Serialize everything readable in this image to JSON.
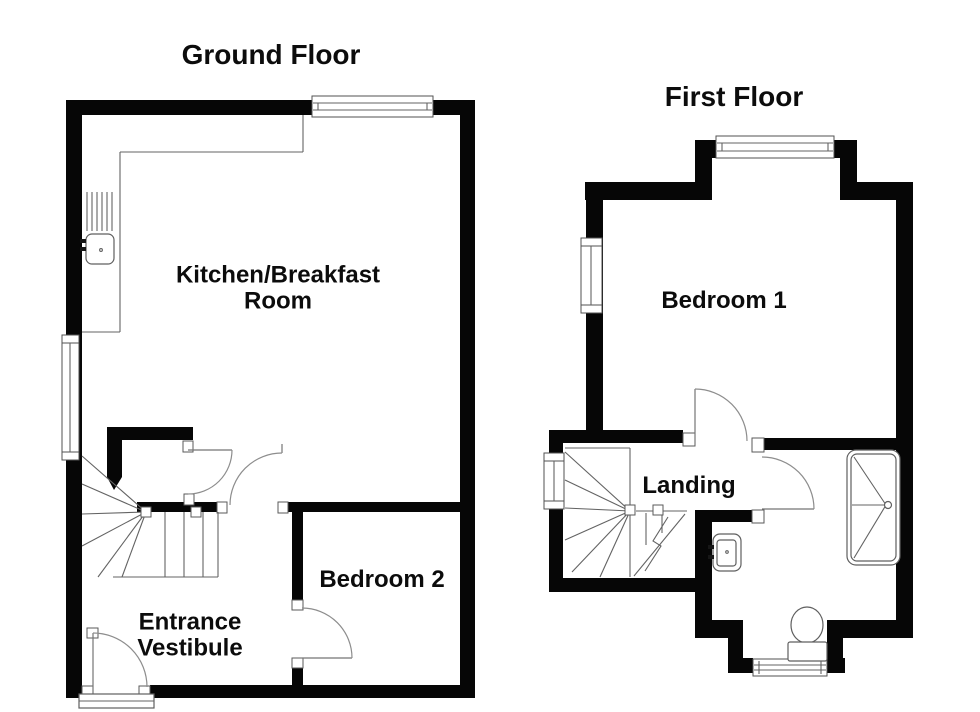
{
  "document_type": "floor-plan-diagram",
  "colors": {
    "wall": "#060606",
    "thin_line": "#636363",
    "door_arc": "#8d8d8d",
    "background": "#ffffff",
    "text": "#0c0c0c"
  },
  "ground_floor": {
    "title": "Ground Floor",
    "rooms": [
      {
        "label": "Kitchen/Breakfast\nRoom"
      },
      {
        "label": "Bedroom 2"
      },
      {
        "label": "Entrance\nVestibule"
      }
    ],
    "fixtures": [
      "kitchen-counter",
      "drainer",
      "kitchen-sink",
      "winder-staircase",
      "under-stair-cupboard",
      "entrance-step",
      "windows",
      "doors"
    ]
  },
  "first_floor": {
    "title": "First Floor",
    "rooms": [
      {
        "label": "Bedroom 1"
      },
      {
        "label": "Landing"
      }
    ],
    "fixtures": [
      "winder-staircase",
      "bathtub",
      "wash-basin",
      "toilet",
      "bay-window",
      "windows",
      "doors"
    ]
  }
}
